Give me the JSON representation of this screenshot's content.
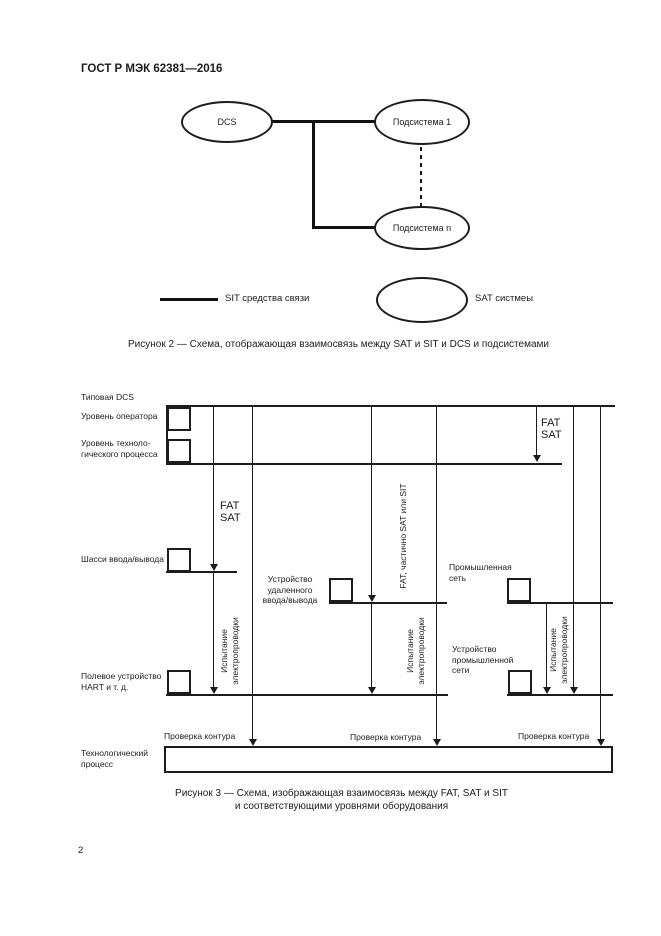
{
  "page": {
    "header": "ГОСТ Р МЭК 62381—2016",
    "number": "2"
  },
  "figure2": {
    "node_dcs": "DCS",
    "node_sub1": "Подсистема 1",
    "node_subn": "Подсистема n",
    "legend_line": "SIT средства связи",
    "legend_ellipse": "SAT систмеы",
    "caption": "Рисунок 2 — Схема, отображающая взаимосвязь между SAT и SIT и DCS и подсистемами"
  },
  "figure3": {
    "typical_dcs": "Типовая DCS",
    "operator_level": "Уровень оператора",
    "process_level_1": "Уровень техноло-",
    "process_level_2": "гического процесса",
    "io_chassis": "Шасси ввода/вывода",
    "field_device_1": "Полевое устройство",
    "field_device_2": "HART и т. д.",
    "tech_process_1": "Технологический",
    "tech_process_2": "процесс",
    "remote_io_1": "Устройство",
    "remote_io_2": "удаленного",
    "remote_io_3": "ввода/вывода",
    "industrial_net_1": "Промышленная",
    "industrial_net_2": "сеть",
    "ind_net_device_1": "Устройство",
    "ind_net_device_2": "промышленной",
    "ind_net_device_3": "сети",
    "fat": "FAT",
    "sat": "SAT",
    "wiring_test_1": "Испытание",
    "wiring_test_2": "электропроводки",
    "fat_partial": "FAT, частично SAT или SIT",
    "loop_check": "Проверка контура",
    "caption_1": "Рисунок 3 — Схема, изображающая взаимосвязь между FAT, SAT и SIT",
    "caption_2": "и соответствующими уровнями оборудования"
  }
}
